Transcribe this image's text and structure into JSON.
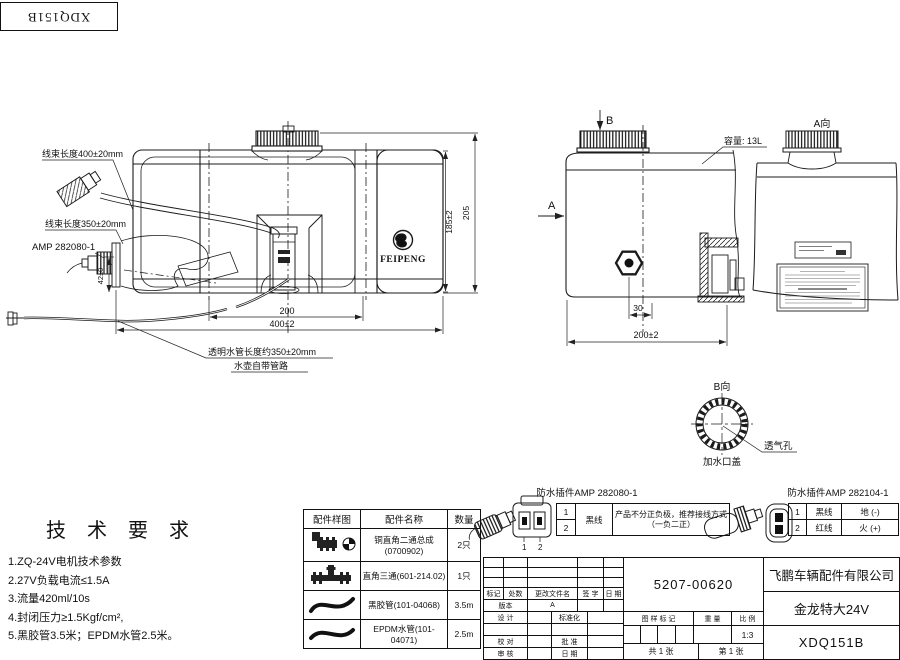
{
  "stamp": {
    "code": "XDQ151B"
  },
  "front_view": {
    "harness_400_label": "线束长度400±20mm",
    "harness_350_label": "线束长度350±20mm",
    "amp_label": "AMP 282080-1",
    "clear_hose_label": "透明水管长度约350±20mm",
    "kettle_pipe_label": "水壶自带管路",
    "brand": "FEIPENG",
    "dim_height_inner": "185±2",
    "dim_height_outer": "205",
    "dim_width_inner": "200",
    "dim_width_outer": "400±2",
    "dim_connector": "42±0"
  },
  "side_view": {
    "view_arrow_b": "B",
    "view_arrow_a": "A",
    "capacity_label": "容量: 13L",
    "dim_offset": "30",
    "dim_depth": "200±2"
  },
  "a_view": {
    "title": "A向"
  },
  "b_view": {
    "title": "B向",
    "filler_cap_label": "加水口盖",
    "vent_label": "透气孔"
  },
  "tech_requirements": {
    "title": "技 术 要 求",
    "items": [
      "1.ZQ-24V电机技术参数",
      "2.27V负载电流≤1.5A",
      "3.流量420ml/10s",
      "4.封闭压力≥1.5Kgf/cm²,",
      "5.黑胶管3.5米；EPDM水管2.5米。"
    ]
  },
  "parts_table": {
    "headers": [
      "配件样图",
      "配件名称",
      "数量"
    ],
    "rows": [
      {
        "name": "铜直角二通总成",
        "sub": "(0700902)",
        "qty": "2只"
      },
      {
        "name": "直角三通(601-214.02)",
        "sub": "",
        "qty": "1只"
      },
      {
        "name": "黑胶管(101-04068)",
        "sub": "",
        "qty": "3.5m"
      },
      {
        "name": "EPDM水管(101-04071)",
        "sub": "",
        "qty": "2.5m"
      }
    ]
  },
  "connector_282080": {
    "title": "防水插件AMP 282080-1",
    "pin1": "1",
    "pin2": "2",
    "wire": "黑线",
    "note_line1": "产品不分正负极，推荐接线方式",
    "note_line2": "（一负二正）"
  },
  "connector_282104": {
    "title": "防水插件AMP 282104-1",
    "rows": [
      {
        "pin": "1",
        "wire": "黑线",
        "role": "地 (-)"
      },
      {
        "pin": "2",
        "wire": "红线",
        "role": "火 (+)"
      }
    ]
  },
  "title_block": {
    "part_number": "5207-00620",
    "company": "飞鹏车辆配件有限公司",
    "product": "金龙特大24V",
    "model": "XDQ151B",
    "rev_headers": [
      "标记",
      "处数",
      "更改文件名",
      "签 字",
      "日 期"
    ],
    "version_label": "版本",
    "version_value": "A",
    "design_label": "设 计",
    "standardization_label": "标准化",
    "check_label": "校 对",
    "approve_label": "批 准",
    "audit_label": "审 核",
    "date_label": "日 期",
    "mark_label": "图 样 标 记",
    "weight_label": "重 量",
    "scale_label": "比 例",
    "scale_value": "1:3",
    "sheet_total": "共 1 张",
    "sheet_page": "第 1 张"
  }
}
